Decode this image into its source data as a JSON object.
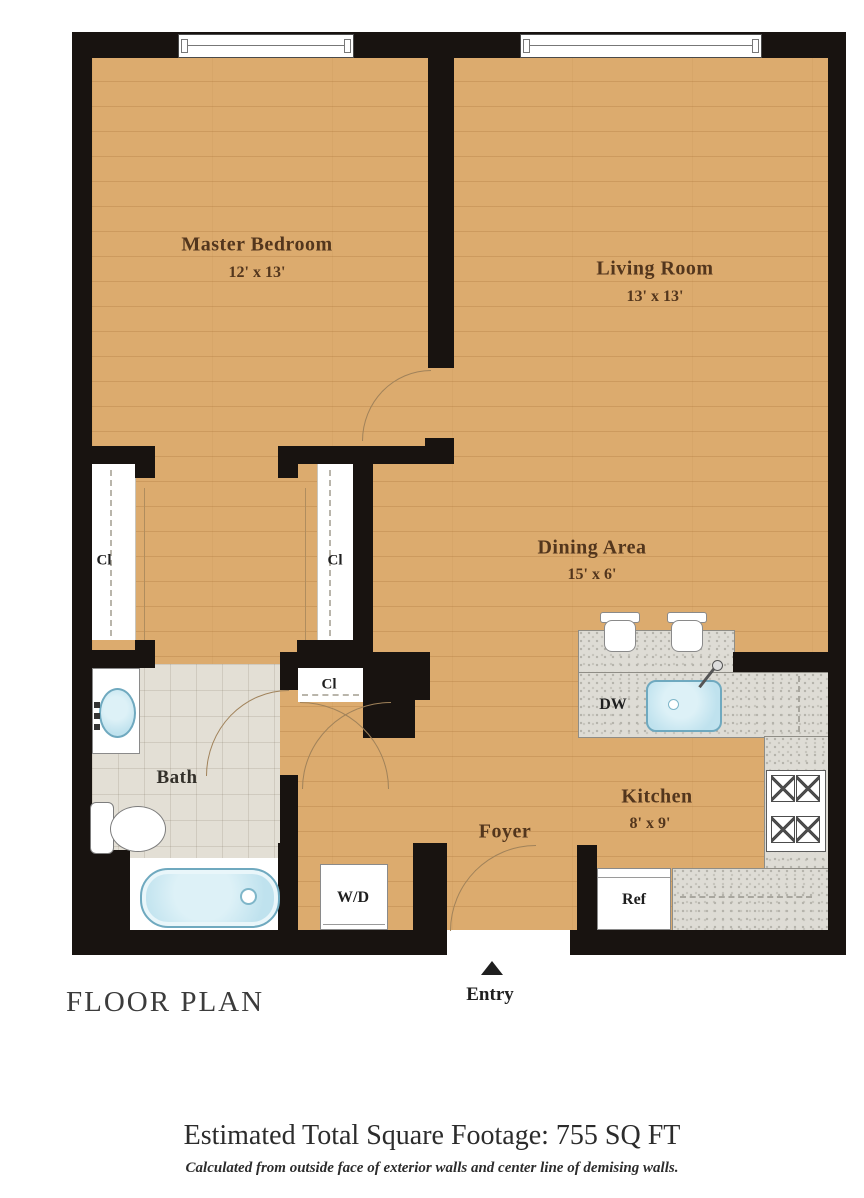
{
  "title": "FLOOR PLAN",
  "entry": {
    "label": "Entry"
  },
  "rooms": {
    "master_bedroom": {
      "name": "Master Bedroom",
      "dims": "12' x 13'"
    },
    "living_room": {
      "name": "Living Room",
      "dims": "13' x 13'"
    },
    "dining_area": {
      "name": "Dining Area",
      "dims": "15' x 6'"
    },
    "kitchen": {
      "name": "Kitchen",
      "dims": "8' x 9'"
    },
    "bath": {
      "name": "Bath"
    },
    "foyer": {
      "name": "Foyer"
    }
  },
  "fixtures": {
    "closet1": "Cl",
    "closet2": "Cl",
    "closet3": "Cl",
    "dishwasher": "DW",
    "refrigerator": "Ref",
    "washer_dryer": "W/D"
  },
  "footer": {
    "total": "Estimated Total Square Footage: 755 SQ FT",
    "note": "Calculated from outside face of exterior walls and center line of demising walls."
  },
  "colors": {
    "wood": "#dcab6e",
    "wall": "#181310",
    "tile": "#e3dfd5",
    "counter": "#dedcd5",
    "blue": "#bfe2ee",
    "blue-edge": "#6fa9bf",
    "brown": "#53361d"
  }
}
